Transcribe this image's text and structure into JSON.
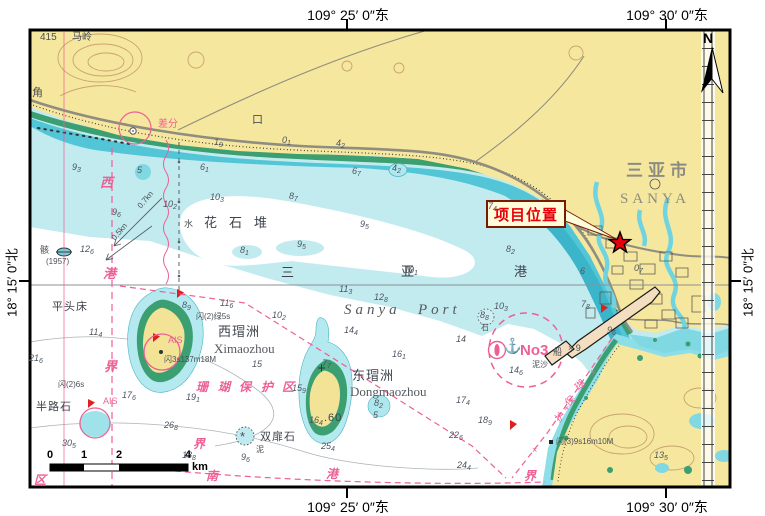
{
  "frame": {
    "top_labels": [
      {
        "text": "109° 25′ 0″东",
        "x": 348
      },
      {
        "text": "109° 30′ 0″东",
        "x": 667
      }
    ],
    "bottom_labels": [
      {
        "text": "109° 25′ 0″东",
        "x": 348
      },
      {
        "text": "109° 30′ 0″东",
        "x": 667
      }
    ],
    "left_label": {
      "text": "18° 15′ 0″北"
    },
    "right_label": {
      "text": "18° 15′ 0″北"
    }
  },
  "scalebar": {
    "ticks": [
      {
        "label": "0",
        "x": 50
      },
      {
        "label": "1",
        "x": 84
      },
      {
        "label": "2",
        "x": 119
      },
      {
        "label": "4",
        "x": 188
      }
    ],
    "unit": "km"
  },
  "callout": {
    "text": "项目位置"
  },
  "colors": {
    "land": "#f6e79e",
    "shallow": "#c2ebf0",
    "band": "#52c5d6",
    "deep_channel": "#3ab5c9",
    "intertidal_green": "#3c9f72",
    "magenta": "#ee5f96",
    "star_red": "#e8000a",
    "callout_bg": "#fffcd9"
  },
  "map_labels": [
    {
      "t": "N",
      "x": 703,
      "y": 31,
      "c": "n",
      "fs": 14
    },
    {
      "t": "415",
      "x": 40,
      "y": 33,
      "c": "g",
      "fs": 10
    },
    {
      "t": "马岭",
      "x": 72,
      "y": 33,
      "c": "g",
      "fs": 10
    },
    {
      "t": "角",
      "x": 32,
      "y": 88,
      "c": "g",
      "fs": 11
    },
    {
      "t": "口",
      "x": 252,
      "y": 115,
      "c": "g",
      "fs": 11
    },
    {
      "t": "差分",
      "x": 158,
      "y": 120,
      "c": "p",
      "fs": 10
    },
    {
      "t": "三亚市",
      "x": 626,
      "y": 162,
      "c": "city",
      "fs": 17
    },
    {
      "t": "SANYA",
      "x": 620,
      "y": 192,
      "c": "city-en",
      "fs": 15
    },
    {
      "t": "花石堆",
      "x": 204,
      "y": 216,
      "c": "g2 wide",
      "fs": 13
    },
    {
      "t": "三",
      "x": 281,
      "y": 266,
      "c": "g2",
      "fs": 13
    },
    {
      "t": "亚",
      "x": 401,
      "y": 265,
      "c": "g2",
      "fs": 13
    },
    {
      "t": "港",
      "x": 514,
      "y": 265,
      "c": "g2",
      "fs": 13
    },
    {
      "t": "Sanya",
      "x": 344,
      "y": 303,
      "c": "en",
      "fs": 15
    },
    {
      "t": "Port",
      "x": 418,
      "y": 303,
      "c": "en",
      "fs": 15
    },
    {
      "t": "西瑁洲",
      "x": 218,
      "y": 325,
      "c": "g2",
      "fs": 13
    },
    {
      "t": "Ximaozhou",
      "x": 214,
      "y": 342,
      "c": "en2",
      "fs": 13
    },
    {
      "t": "东瑁洲",
      "x": 352,
      "y": 369,
      "c": "g2",
      "fs": 13
    },
    {
      "t": "Dongmaozhou",
      "x": 350,
      "y": 385,
      "c": "en2",
      "fs": 13
    },
    {
      "t": "平头床",
      "x": 52,
      "y": 302,
      "c": "g2",
      "fs": 11
    },
    {
      "t": "半路石",
      "x": 36,
      "y": 402,
      "c": "g2",
      "fs": 11
    },
    {
      "t": "双扉石",
      "x": 260,
      "y": 432,
      "c": "g2",
      "fs": 11
    },
    {
      "t": ".60",
      "x": 324,
      "y": 413,
      "c": "g2",
      "fs": 11
    },
    {
      "t": "骸",
      "x": 40,
      "y": 246,
      "c": "g",
      "fs": 9
    },
    {
      "t": "(1957)",
      "x": 46,
      "y": 258,
      "c": "g",
      "fs": 8
    },
    {
      "t": "西",
      "x": 100,
      "y": 176,
      "c": "pb",
      "fs": 13
    },
    {
      "t": "港",
      "x": 103,
      "y": 267,
      "c": "pb",
      "fs": 13
    },
    {
      "t": "界",
      "x": 104,
      "y": 360,
      "c": "pb",
      "fs": 13
    },
    {
      "t": "界",
      "x": 193,
      "y": 438,
      "c": "pb",
      "fs": 12
    },
    {
      "t": "南",
      "x": 206,
      "y": 470,
      "c": "pb",
      "fs": 12
    },
    {
      "t": "港",
      "x": 326,
      "y": 468,
      "c": "pb",
      "fs": 12
    },
    {
      "t": "界",
      "x": 524,
      "y": 470,
      "c": "pb",
      "fs": 12
    },
    {
      "t": "区",
      "x": 34,
      "y": 474,
      "c": "pb",
      "fs": 12
    },
    {
      "t": "珊",
      "x": 196,
      "y": 381,
      "c": "pb",
      "fs": 12
    },
    {
      "t": "瑚",
      "x": 218,
      "y": 381,
      "c": "pb",
      "fs": 12
    },
    {
      "t": "保",
      "x": 239,
      "y": 381,
      "c": "pb",
      "fs": 12
    },
    {
      "t": "护",
      "x": 261,
      "y": 381,
      "c": "pb",
      "fs": 12
    },
    {
      "t": "区",
      "x": 282,
      "y": 381,
      "c": "pb",
      "fs": 12
    },
    {
      "t": "瑚",
      "x": 576,
      "y": 381,
      "c": "p",
      "fs": 10,
      "r": -42
    },
    {
      "t": "保",
      "x": 566,
      "y": 397,
      "c": "p",
      "fs": 10,
      "r": -42
    },
    {
      "t": "护",
      "x": 556,
      "y": 413,
      "c": "p",
      "fs": 10,
      "r": -42
    },
    {
      "t": "×",
      "x": 590,
      "y": 368,
      "c": "p",
      "fs": 9
    },
    {
      "t": "×",
      "x": 564,
      "y": 404,
      "c": "p",
      "fs": 9
    },
    {
      "t": "×",
      "x": 532,
      "y": 446,
      "c": "p",
      "fs": 9
    },
    {
      "t": "AIS",
      "x": 168,
      "y": 336,
      "c": "p",
      "fs": 9
    },
    {
      "t": "AIS",
      "x": 103,
      "y": 397,
      "c": "p",
      "fs": 9
    },
    {
      "t": "⚓",
      "x": 503,
      "y": 339,
      "c": "pno3",
      "fs": 15
    },
    {
      "t": "No3",
      "x": 520,
      "y": 343,
      "c": "pno3",
      "fs": 15
    },
    {
      "t": "闪(2)绿5s",
      "x": 196,
      "y": 313,
      "c": "g",
      "fs": 8
    },
    {
      "t": "闪3s137m18M",
      "x": 164,
      "y": 356,
      "c": "g",
      "fs": 8
    },
    {
      "t": "闪(2)6s",
      "x": 58,
      "y": 381,
      "c": "g",
      "fs": 8
    },
    {
      "t": "闪(3)9s16m10M",
      "x": 556,
      "y": 438,
      "c": "g",
      "fs": 8
    },
    {
      "t": "泥沙",
      "x": 532,
      "y": 361,
      "c": "g",
      "fs": 8
    },
    {
      "t": "泥",
      "x": 256,
      "y": 446,
      "c": "g",
      "fs": 8
    },
    {
      "t": "船",
      "x": 553,
      "y": 348,
      "c": "g",
      "fs": 9
    },
    {
      "t": "× 9",
      "x": 568,
      "y": 344,
      "c": "g",
      "fs": 9
    },
    {
      "t": "水",
      "x": 184,
      "y": 220,
      "c": "g",
      "fs": 9
    },
    {
      "t": "*",
      "x": 240,
      "y": 430,
      "c": "g",
      "fs": 13
    },
    {
      "t": "石",
      "x": 481,
      "y": 324,
      "c": "g",
      "fs": 8
    },
    {
      "t": "0.7kn",
      "x": 136,
      "y": 196,
      "c": "g",
      "fs": 8,
      "r": -50
    },
    {
      "t": "0.5kn",
      "x": 110,
      "y": 228,
      "c": "g",
      "fs": 8,
      "r": -50
    }
  ],
  "depths": [
    {
      "x": 72,
      "y": 163,
      "v": "9",
      "s": "3"
    },
    {
      "x": 112,
      "y": 208,
      "v": "9",
      "s": "6"
    },
    {
      "x": 163,
      "y": 200,
      "v": "10",
      "s": "2"
    },
    {
      "x": 200,
      "y": 163,
      "v": "6",
      "s": "1"
    },
    {
      "x": 352,
      "y": 167,
      "v": "6",
      "s": "7"
    },
    {
      "x": 289,
      "y": 192,
      "v": "8",
      "s": "7"
    },
    {
      "x": 210,
      "y": 193,
      "v": "10",
      "s": "3"
    },
    {
      "x": 360,
      "y": 220,
      "v": "9",
      "s": "5"
    },
    {
      "x": 297,
      "y": 240,
      "v": "9",
      "s": "5"
    },
    {
      "x": 240,
      "y": 246,
      "v": "8",
      "s": "1"
    },
    {
      "x": 214,
      "y": 138,
      "v": "1",
      "s": "9"
    },
    {
      "x": 282,
      "y": 136,
      "v": "0",
      "s": "1"
    },
    {
      "x": 336,
      "y": 139,
      "v": "4",
      "s": "2"
    },
    {
      "x": 488,
      "y": 202,
      "v": "7",
      "s": "4"
    },
    {
      "x": 506,
      "y": 245,
      "v": "8",
      "s": "2"
    },
    {
      "x": 580,
      "y": 267,
      "v": "6",
      "s": ""
    },
    {
      "x": 634,
      "y": 264,
      "v": "0",
      "s": "7"
    },
    {
      "x": 404,
      "y": 266,
      "v": "10",
      "s": "1"
    },
    {
      "x": 339,
      "y": 285,
      "v": "11",
      "s": "3"
    },
    {
      "x": 374,
      "y": 293,
      "v": "12",
      "s": "8"
    },
    {
      "x": 272,
      "y": 311,
      "v": "10",
      "s": "2"
    },
    {
      "x": 344,
      "y": 326,
      "v": "14",
      "s": "4"
    },
    {
      "x": 456,
      "y": 335,
      "v": "14",
      "s": ""
    },
    {
      "x": 392,
      "y": 350,
      "v": "16",
      "s": "1"
    },
    {
      "x": 252,
      "y": 360,
      "v": "15",
      "s": ""
    },
    {
      "x": 509,
      "y": 366,
      "v": "14",
      "s": "6"
    },
    {
      "x": 456,
      "y": 396,
      "v": "17",
      "s": "4"
    },
    {
      "x": 478,
      "y": 416,
      "v": "18",
      "s": "9"
    },
    {
      "x": 449,
      "y": 431,
      "v": "22",
      "s": "6"
    },
    {
      "x": 457,
      "y": 461,
      "v": "24",
      "s": "4"
    },
    {
      "x": 321,
      "y": 442,
      "v": "25",
      "s": "4"
    },
    {
      "x": 182,
      "y": 451,
      "v": "18",
      "s": "8"
    },
    {
      "x": 309,
      "y": 416,
      "v": "16",
      "s": "4"
    },
    {
      "x": 292,
      "y": 384,
      "v": "15",
      "s": "9"
    },
    {
      "x": 186,
      "y": 393,
      "v": "19",
      "s": "1"
    },
    {
      "x": 164,
      "y": 421,
      "v": "26",
      "s": "8"
    },
    {
      "x": 62,
      "y": 439,
      "v": "30",
      "s": "5"
    },
    {
      "x": 29,
      "y": 354,
      "v": "21",
      "s": "6"
    },
    {
      "x": 122,
      "y": 391,
      "v": "17",
      "s": "6"
    },
    {
      "x": 89,
      "y": 328,
      "v": "11",
      "s": "4"
    },
    {
      "x": 80,
      "y": 245,
      "v": "12",
      "s": "6"
    },
    {
      "x": 182,
      "y": 301,
      "v": "8",
      "s": "9"
    },
    {
      "x": 220,
      "y": 299,
      "v": "11",
      "s": "6"
    },
    {
      "x": 581,
      "y": 300,
      "v": "7",
      "s": "8"
    },
    {
      "x": 607,
      "y": 326,
      "v": "9",
      "s": "6"
    },
    {
      "x": 654,
      "y": 451,
      "v": "13",
      "s": "5"
    },
    {
      "x": 322,
      "y": 359,
      "v": "7",
      "s": "7"
    },
    {
      "x": 241,
      "y": 453,
      "v": "9",
      "s": "6"
    },
    {
      "x": 494,
      "y": 302,
      "v": "10",
      "s": "3"
    },
    {
      "x": 137,
      "y": 166,
      "v": "5",
      "s": ""
    },
    {
      "x": 392,
      "y": 164,
      "v": "4",
      "s": "2"
    },
    {
      "x": 480,
      "y": 311,
      "v": "8",
      "s": "8"
    },
    {
      "x": 374,
      "y": 399,
      "v": "8",
      "s": "2"
    },
    {
      "x": 373,
      "y": 411,
      "v": "5",
      "s": ""
    }
  ]
}
